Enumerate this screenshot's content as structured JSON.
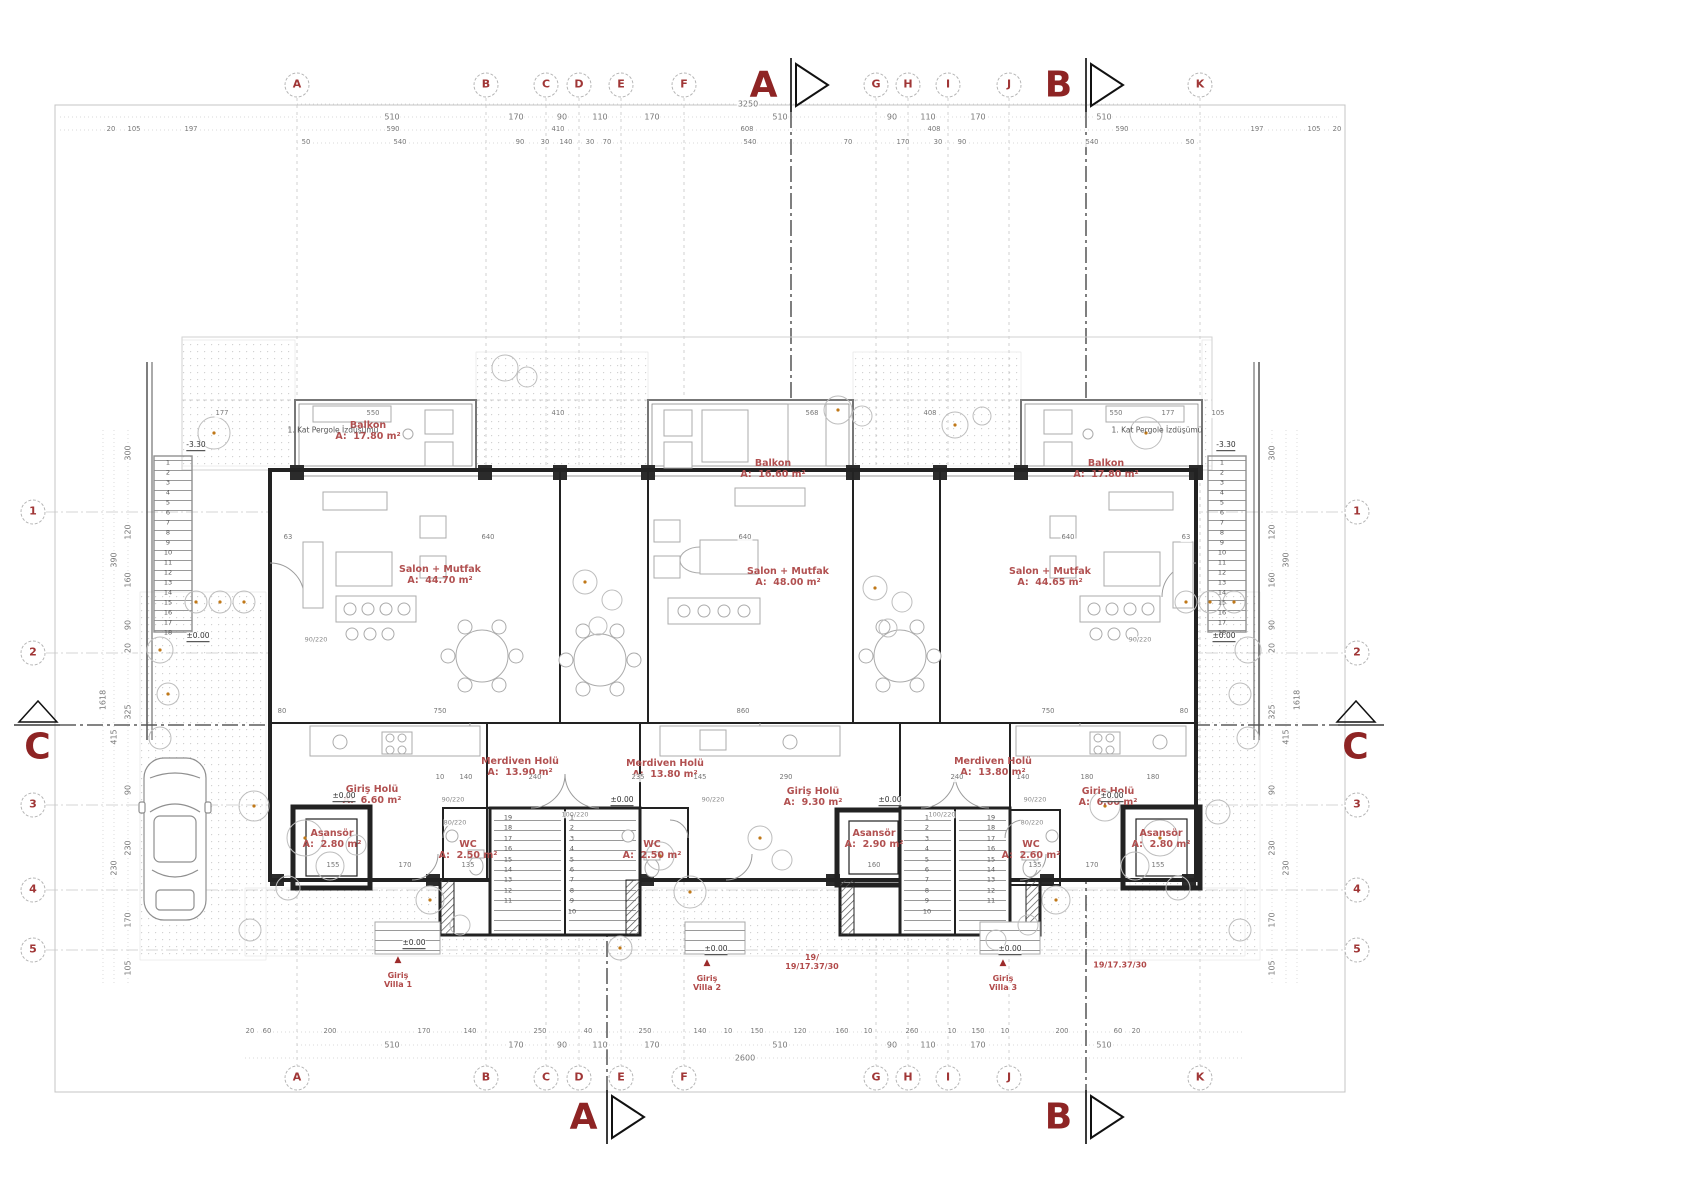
{
  "grid": {
    "top_y": 85,
    "bottom_y": 1078,
    "left_x": 33,
    "right_x": 1357,
    "columns": [
      {
        "label": "A",
        "x": 297
      },
      {
        "label": "B",
        "x": 486
      },
      {
        "label": "C",
        "x": 546
      },
      {
        "label": "D",
        "x": 579
      },
      {
        "label": "E",
        "x": 621
      },
      {
        "label": "F",
        "x": 684
      },
      {
        "label": "G",
        "x": 876
      },
      {
        "label": "H",
        "x": 908
      },
      {
        "label": "I",
        "x": 948
      },
      {
        "label": "J",
        "x": 1009
      },
      {
        "label": "K",
        "x": 1200
      }
    ],
    "rows": [
      {
        "label": "1",
        "y": 512
      },
      {
        "label": "2",
        "y": 653
      },
      {
        "label": "3",
        "y": 805
      },
      {
        "label": "4",
        "y": 890
      },
      {
        "label": "5",
        "y": 950
      }
    ]
  },
  "sections": [
    {
      "label": "A",
      "x": 764,
      "y": 85
    },
    {
      "label": "B",
      "x": 1059,
      "y": 85
    },
    {
      "label": "A",
      "x": 584,
      "y": 1117
    },
    {
      "label": "B",
      "x": 1059,
      "y": 1117
    },
    {
      "label": "C",
      "x": 38,
      "y": 747
    },
    {
      "label": "C",
      "x": 1356,
      "y": 747
    }
  ],
  "rooms": [
    {
      "name": "Balkon",
      "area": "A:  17.80 m²",
      "x": 368,
      "y": 432
    },
    {
      "name": "Balkon",
      "area": "A:  16.60 m²",
      "x": 773,
      "y": 470
    },
    {
      "name": "Balkon",
      "area": "A:  17.80 m²",
      "x": 1106,
      "y": 470
    },
    {
      "name": "Salon + Mutfak",
      "area": "A:  44.70 m²",
      "x": 440,
      "y": 576
    },
    {
      "name": "Salon + Mutfak",
      "area": "A:  48.00 m²",
      "x": 788,
      "y": 578
    },
    {
      "name": "Salon + Mutfak",
      "area": "A:  44.65 m²",
      "x": 1050,
      "y": 578
    },
    {
      "name": "Merdiven Holü",
      "area": "A:  13.90 m²",
      "x": 520,
      "y": 768
    },
    {
      "name": "Merdiven Holü",
      "area": "A:  13.80 m²",
      "x": 665,
      "y": 770
    },
    {
      "name": "Merdiven Holü",
      "area": "A:  13.80 m²",
      "x": 993,
      "y": 768
    },
    {
      "name": "Giriş Holü",
      "area": "A:  6.60 m²",
      "x": 372,
      "y": 796
    },
    {
      "name": "Giriş Holü",
      "area": "A:  9.30 m²",
      "x": 813,
      "y": 798
    },
    {
      "name": "Giriş Holü",
      "area": "A:  6.60 m²",
      "x": 1108,
      "y": 798
    },
    {
      "name": "Asansör",
      "area": "A:  2.80 m²",
      "x": 332,
      "y": 840
    },
    {
      "name": "Asansör",
      "area": "A:  2.90 m²",
      "x": 874,
      "y": 840
    },
    {
      "name": "Asansör",
      "area": "A:  2.80 m²",
      "x": 1161,
      "y": 840
    },
    {
      "name": "WC",
      "area": "A:  2.50 m²",
      "x": 468,
      "y": 851
    },
    {
      "name": "WC",
      "area": "A:  2.50 m²",
      "x": 652,
      "y": 851
    },
    {
      "name": "WC",
      "area": "A:  2.60 m²",
      "x": 1031,
      "y": 851
    }
  ],
  "dimensions": {
    "h_groups": [
      {
        "y": 104,
        "items": [
          {
            "t": "3250",
            "x": 748
          }
        ]
      },
      {
        "y": 117,
        "items": [
          {
            "t": "510",
            "x": 392
          },
          {
            "t": "170",
            "x": 516
          },
          {
            "t": "90",
            "x": 562
          },
          {
            "t": "110",
            "x": 600
          },
          {
            "t": "170",
            "x": 652
          },
          {
            "t": "510",
            "x": 780
          },
          {
            "t": "90",
            "x": 892
          },
          {
            "t": "110",
            "x": 928
          },
          {
            "t": "170",
            "x": 978
          },
          {
            "t": "510",
            "x": 1104
          }
        ]
      },
      {
        "y": 130,
        "small": true,
        "items": [
          {
            "t": "20",
            "x": 111
          },
          {
            "t": "105",
            "x": 134
          },
          {
            "t": "197",
            "x": 191
          },
          {
            "t": "590",
            "x": 393
          },
          {
            "t": "410",
            "x": 558
          },
          {
            "t": "608",
            "x": 747
          },
          {
            "t": "408",
            "x": 934
          },
          {
            "t": "590",
            "x": 1122
          },
          {
            "t": "197",
            "x": 1257
          },
          {
            "t": "105",
            "x": 1314
          },
          {
            "t": "20",
            "x": 1337
          }
        ]
      },
      {
        "y": 143,
        "small": true,
        "items": [
          {
            "t": "50",
            "x": 306
          },
          {
            "t": "540",
            "x": 400
          },
          {
            "t": "90",
            "x": 520
          },
          {
            "t": "30",
            "x": 545
          },
          {
            "t": "140",
            "x": 566
          },
          {
            "t": "30",
            "x": 590
          },
          {
            "t": "70",
            "x": 607
          },
          {
            "t": "540",
            "x": 750
          },
          {
            "t": "70",
            "x": 848
          },
          {
            "t": "170",
            "x": 903
          },
          {
            "t": "30",
            "x": 938
          },
          {
            "t": "90",
            "x": 962
          },
          {
            "t": "540",
            "x": 1092
          },
          {
            "t": "50",
            "x": 1190
          }
        ]
      },
      {
        "y": 414,
        "small": true,
        "items": [
          {
            "t": "177",
            "x": 222
          },
          {
            "t": "550",
            "x": 373
          },
          {
            "t": "410",
            "x": 558
          },
          {
            "t": "568",
            "x": 812
          },
          {
            "t": "408",
            "x": 930
          },
          {
            "t": "550",
            "x": 1116
          },
          {
            "t": "177",
            "x": 1168
          },
          {
            "t": "105",
            "x": 1218
          }
        ]
      },
      {
        "y": 538,
        "small": true,
        "items": [
          {
            "t": "640",
            "x": 488
          },
          {
            "t": "640",
            "x": 745
          },
          {
            "t": "640",
            "x": 1068
          },
          {
            "t": "63",
            "x": 288
          },
          {
            "t": "63",
            "x": 1186
          }
        ]
      },
      {
        "y": 712,
        "small": true,
        "items": [
          {
            "t": "80",
            "x": 282
          },
          {
            "t": "750",
            "x": 440
          },
          {
            "t": "860",
            "x": 743
          },
          {
            "t": "750",
            "x": 1048
          },
          {
            "t": "80",
            "x": 1184
          }
        ]
      },
      {
        "y": 778,
        "small": true,
        "items": [
          {
            "t": "240",
            "x": 535
          },
          {
            "t": "10",
            "x": 440
          },
          {
            "t": "140",
            "x": 466
          },
          {
            "t": "235",
            "x": 638
          },
          {
            "t": "145",
            "x": 700
          },
          {
            "t": "290",
            "x": 786
          },
          {
            "t": "240",
            "x": 957
          },
          {
            "t": "140",
            "x": 1023
          },
          {
            "t": "180",
            "x": 1087
          },
          {
            "t": "180",
            "x": 1153
          }
        ]
      },
      {
        "y": 866,
        "small": true,
        "items": [
          {
            "t": "155",
            "x": 333
          },
          {
            "t": "170",
            "x": 405
          },
          {
            "t": "135",
            "x": 468
          },
          {
            "t": "160",
            "x": 874
          },
          {
            "t": "135",
            "x": 1035
          },
          {
            "t": "170",
            "x": 1092
          },
          {
            "t": "155",
            "x": 1158
          }
        ]
      },
      {
        "y": 1032,
        "small": true,
        "items": [
          {
            "t": "20",
            "x": 250
          },
          {
            "t": "60",
            "x": 267
          },
          {
            "t": "200",
            "x": 330
          },
          {
            "t": "170",
            "x": 424
          },
          {
            "t": "140",
            "x": 470
          },
          {
            "t": "250",
            "x": 540
          },
          {
            "t": "40",
            "x": 588
          },
          {
            "t": "250",
            "x": 645
          },
          {
            "t": "140",
            "x": 700
          },
          {
            "t": "10",
            "x": 728
          },
          {
            "t": "150",
            "x": 757
          },
          {
            "t": "120",
            "x": 800
          },
          {
            "t": "160",
            "x": 842
          },
          {
            "t": "10",
            "x": 868
          },
          {
            "t": "260",
            "x": 912
          },
          {
            "t": "10",
            "x": 952
          },
          {
            "t": "150",
            "x": 978
          },
          {
            "t": "10",
            "x": 1005
          },
          {
            "t": "200",
            "x": 1062
          },
          {
            "t": "60",
            "x": 1118
          },
          {
            "t": "20",
            "x": 1136
          }
        ]
      },
      {
        "y": 1045,
        "items": [
          {
            "t": "510",
            "x": 392
          },
          {
            "t": "170",
            "x": 516
          },
          {
            "t": "90",
            "x": 562
          },
          {
            "t": "110",
            "x": 600
          },
          {
            "t": "170",
            "x": 652
          },
          {
            "t": "510",
            "x": 780
          },
          {
            "t": "90",
            "x": 892
          },
          {
            "t": "110",
            "x": 928
          },
          {
            "t": "170",
            "x": 978
          },
          {
            "t": "510",
            "x": 1104
          }
        ]
      },
      {
        "y": 1058,
        "items": [
          {
            "t": "2600",
            "x": 745
          }
        ]
      }
    ],
    "v_groups": [
      {
        "x": 128,
        "items": [
          {
            "t": "300",
            "y": 453
          },
          {
            "t": "120",
            "y": 532
          },
          {
            "t": "160",
            "y": 580
          },
          {
            "t": "90",
            "y": 625
          },
          {
            "t": "20",
            "y": 648
          },
          {
            "t": "325",
            "y": 712
          },
          {
            "t": "90",
            "y": 790
          },
          {
            "t": "230",
            "y": 848
          },
          {
            "t": "170",
            "y": 920
          },
          {
            "t": "105",
            "y": 968
          }
        ]
      },
      {
        "x": 114,
        "items": [
          {
            "t": "390",
            "y": 560
          },
          {
            "t": "415",
            "y": 737
          },
          {
            "t": "230",
            "y": 868
          }
        ]
      },
      {
        "x": 103,
        "items": [
          {
            "t": "1618",
            "y": 700
          }
        ]
      },
      {
        "x": 1272,
        "items": [
          {
            "t": "300",
            "y": 453
          },
          {
            "t": "120",
            "y": 532
          },
          {
            "t": "160",
            "y": 580
          },
          {
            "t": "90",
            "y": 625
          },
          {
            "t": "20",
            "y": 648
          },
          {
            "t": "325",
            "y": 712
          },
          {
            "t": "90",
            "y": 790
          },
          {
            "t": "230",
            "y": 848
          },
          {
            "t": "170",
            "y": 920
          },
          {
            "t": "105",
            "y": 968
          }
        ]
      },
      {
        "x": 1286,
        "items": [
          {
            "t": "390",
            "y": 560
          },
          {
            "t": "415",
            "y": 737
          },
          {
            "t": "230",
            "y": 868
          }
        ]
      },
      {
        "x": 1297,
        "items": [
          {
            "t": "1618",
            "y": 700
          }
        ]
      }
    ]
  },
  "annotations": [
    {
      "t": "1. Kat Pergole İzdüşümü",
      "x": 333,
      "y": 431,
      "c": "note",
      "n": "pergola-note"
    },
    {
      "t": "1. Kat Pergole İzdüşümü",
      "x": 1157,
      "y": 431,
      "c": "note",
      "n": "pergola-note"
    },
    {
      "t": "-3.30",
      "x": 196,
      "y": 446,
      "c": "lvl",
      "n": "level-marker"
    },
    {
      "t": "-3.30",
      "x": 1226,
      "y": 446,
      "c": "lvl",
      "n": "level-marker"
    },
    {
      "t": "±0.00",
      "x": 198,
      "y": 637,
      "c": "lvl",
      "n": "level-marker"
    },
    {
      "t": "±0.00",
      "x": 1224,
      "y": 637,
      "c": "lvl",
      "n": "level-marker"
    },
    {
      "t": "±0.00",
      "x": 344,
      "y": 797,
      "c": "lvl",
      "n": "level-marker"
    },
    {
      "t": "±0.00",
      "x": 622,
      "y": 801,
      "c": "lvl",
      "n": "level-marker"
    },
    {
      "t": "±0.00",
      "x": 890,
      "y": 801,
      "c": "lvl",
      "n": "level-marker"
    },
    {
      "t": "±0.00",
      "x": 1112,
      "y": 797,
      "c": "lvl",
      "n": "level-marker"
    },
    {
      "t": "±0.00",
      "x": 414,
      "y": 944,
      "c": "lvl",
      "n": "level-marker"
    },
    {
      "t": "±0.00",
      "x": 716,
      "y": 950,
      "c": "lvl",
      "n": "level-marker"
    },
    {
      "t": "±0.00",
      "x": 1010,
      "y": 950,
      "c": "lvl",
      "n": "level-marker"
    },
    {
      "t": "▲",
      "x": 398,
      "y": 960,
      "c": "tri",
      "n": "entry-triangle"
    },
    {
      "t": "Giriş\nVilla 1",
      "x": 398,
      "y": 980,
      "c": "red",
      "n": "entry-label"
    },
    {
      "t": "▲",
      "x": 707,
      "y": 963,
      "c": "tri",
      "n": "entry-triangle"
    },
    {
      "t": "Giriş\nVilla 2",
      "x": 707,
      "y": 983,
      "c": "red",
      "n": "entry-label"
    },
    {
      "t": "▲",
      "x": 1003,
      "y": 963,
      "c": "tri",
      "n": "entry-triangle"
    },
    {
      "t": "Giriş\nVilla 3",
      "x": 1003,
      "y": 983,
      "c": "red",
      "n": "entry-label"
    },
    {
      "t": "19/\n19/17.37/30",
      "x": 812,
      "y": 962,
      "c": "red",
      "n": "stair-calc-note"
    },
    {
      "t": "19/17.37/30",
      "x": 1120,
      "y": 965,
      "c": "red",
      "n": "stair-calc-note"
    },
    {
      "t": "90/220",
      "x": 316,
      "y": 640,
      "c": "tag",
      "n": "door-tag"
    },
    {
      "t": "90/220",
      "x": 453,
      "y": 800,
      "c": "tag",
      "n": "door-tag"
    },
    {
      "t": "80/220",
      "x": 455,
      "y": 823,
      "c": "tag",
      "n": "door-tag"
    },
    {
      "t": "100/220",
      "x": 575,
      "y": 815,
      "c": "tag",
      "n": "door-tag"
    },
    {
      "t": "90/220",
      "x": 713,
      "y": 800,
      "c": "tag",
      "n": "door-tag"
    },
    {
      "t": "80/220",
      "x": 1032,
      "y": 823,
      "c": "tag",
      "n": "door-tag"
    },
    {
      "t": "90/220",
      "x": 1035,
      "y": 800,
      "c": "tag",
      "n": "door-tag"
    },
    {
      "t": "100/220",
      "x": 942,
      "y": 815,
      "c": "tag",
      "n": "door-tag"
    },
    {
      "t": "90/220",
      "x": 1140,
      "y": 640,
      "c": "tag",
      "n": "door-tag"
    }
  ],
  "stair_number_columns": [
    {
      "x": 168,
      "y0": 463,
      "dy": 10,
      "nums": [
        1,
        2,
        3,
        4,
        5,
        6,
        7,
        8,
        9,
        10,
        11,
        12,
        13,
        14,
        15,
        16,
        17,
        18
      ]
    },
    {
      "x": 1222,
      "y0": 463,
      "dy": 10,
      "nums": [
        1,
        2,
        3,
        4,
        5,
        6,
        7,
        8,
        9,
        10,
        11,
        12,
        13,
        14,
        15,
        16,
        17,
        18
      ]
    },
    {
      "x": 508,
      "y0": 818,
      "dy": 10.4,
      "nums": [
        19,
        18,
        17,
        16,
        15,
        14,
        13,
        12,
        11
      ]
    },
    {
      "x": 572,
      "y0": 818,
      "dy": 10.4,
      "nums": [
        1,
        2,
        3,
        4,
        5,
        6,
        7,
        8,
        9,
        10
      ]
    },
    {
      "x": 927,
      "y0": 818,
      "dy": 10.4,
      "nums": [
        1,
        2,
        3,
        4,
        5,
        6,
        7,
        8,
        9,
        10
      ]
    },
    {
      "x": 991,
      "y0": 818,
      "dy": 10.4,
      "nums": [
        19,
        18,
        17,
        16,
        15,
        14,
        13,
        12,
        11
      ]
    }
  ],
  "colors": {
    "accent_red": "#a03636",
    "section_red": "#8e2424",
    "label_red": "#b15050",
    "wall": "#222222",
    "tree_dot": "#c07818"
  }
}
